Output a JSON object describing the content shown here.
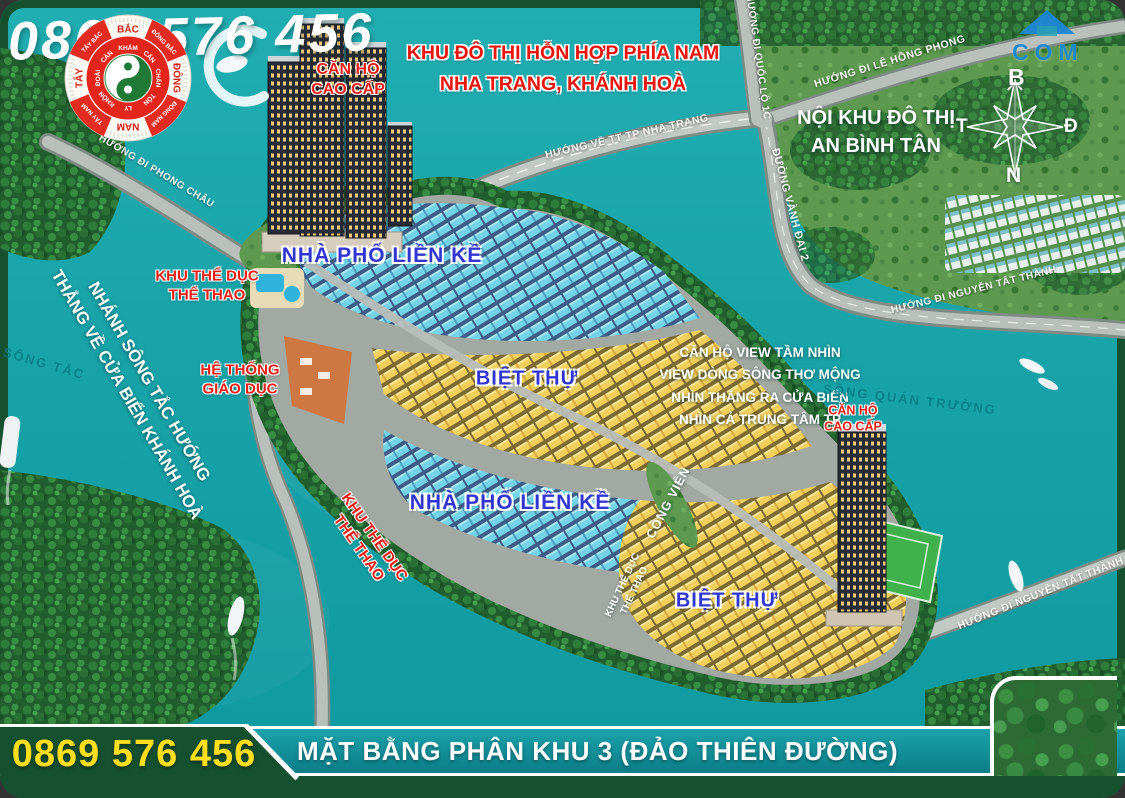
{
  "header": {
    "phone": "0869 576 456",
    "banner_line1": "KHU ĐÔ THỊ HỖN HỢP PHÍA NAM",
    "banner_line2": "NHA TRANG, KHÁNH HOÀ"
  },
  "watermark": {
    "text": "COM",
    "icon": "house-icon"
  },
  "compass": {
    "north": "B",
    "west": "T",
    "east": "Đ",
    "south": "N"
  },
  "fengshui": {
    "cardinals": [
      "BẮC",
      "ĐÔNG",
      "NAM",
      "TÂY"
    ],
    "intercardinals": [
      "ĐÔNG BẮC",
      "ĐÔNG NAM",
      "TÂY NAM",
      "TÂY BẮC"
    ],
    "trigrams": [
      "KHẢM",
      "CẤN",
      "CHẤN",
      "TỐN",
      "LY",
      "KHÔN",
      "ĐOÀI",
      "CÀN"
    ]
  },
  "areas": {
    "noi_khu_line1": "NỘI KHU ĐÔ THỊ",
    "noi_khu_line2": "AN BÌNH TÂN",
    "apartment_left": [
      "CĂN HỘ",
      "CAO CẤP"
    ],
    "apartment_right": [
      "CĂN HỘ",
      "CAO CẤP"
    ],
    "sports_1": [
      "KHU THỂ DỤC",
      "THỂ THAO"
    ],
    "sports_2": [
      "KHU THỂ DỤC",
      "THỂ THAO"
    ],
    "sports_small": [
      "KHU THỂ DỤC",
      "THỂ THAO"
    ],
    "education": [
      "HỆ THỐNG",
      "GIÁO DỤC"
    ],
    "townhouse_1": "NHÀ  PHỐ LIỀN KỀ",
    "townhouse_2": "NHÀ  PHỐ LIỀN KỀ",
    "villa_1": "BIỆT THỰ",
    "villa_2": "BIỆT THỰ",
    "park": "CÔNG VIÊN",
    "view_block": [
      "CĂN HỘ VIEW TẦM NHÌN",
      "VIEW DÒNG SÔNG THƠ MỘNG",
      "NHÌN THẲNG RA CỬA BIỂN",
      "NHÌN CẢ TRUNG TÂM TP"
    ],
    "west_note_line1": "NHÁNH SÔNG TẮC HƯỚNG",
    "west_note_line2": "THẲNG VỀ CỬA BIỂN KHÁNH HOÀ"
  },
  "rivers": {
    "song_tac": "SÔNG TẮC",
    "song_quan_truong": "SÔNG QUÁN TRƯỜNG"
  },
  "roads": {
    "phong_chau": "HƯỚNG ĐI PHONG CHÂU",
    "nha_trang": "HƯỚNG VỀ TT TP NHA TRANG",
    "quoc_lo_1c": "HƯỚNG ĐI QUỐC LỘ 1C",
    "le_hong_phong": "HƯỚNG ĐI LÊ HỒNG PHONG",
    "vanh_dai_2": "ĐƯỜNG VÀNH ĐAI 2",
    "nguyen_tat_thanh_1": "HƯỚNG ĐI NGUYỄN TẤT THÀNH",
    "nguyen_tat_thanh_2": "HƯỚNG ĐI NGUYỄN TẤT THÀNH"
  },
  "footer": {
    "phone": "0869 576 456",
    "title": "MẶT BẰNG PHÂN KHU 3 (ĐẢO THIÊN ĐƯỜNG)"
  },
  "colors": {
    "water": "#17a3a8",
    "frame_green": "#15502f",
    "label_red": "#e81d13",
    "label_blue": "#3136d2",
    "phone_yellow": "#ffdf1b",
    "roof_cyan": "#72d3e6",
    "roof_yellow": "#f0d05a"
  }
}
